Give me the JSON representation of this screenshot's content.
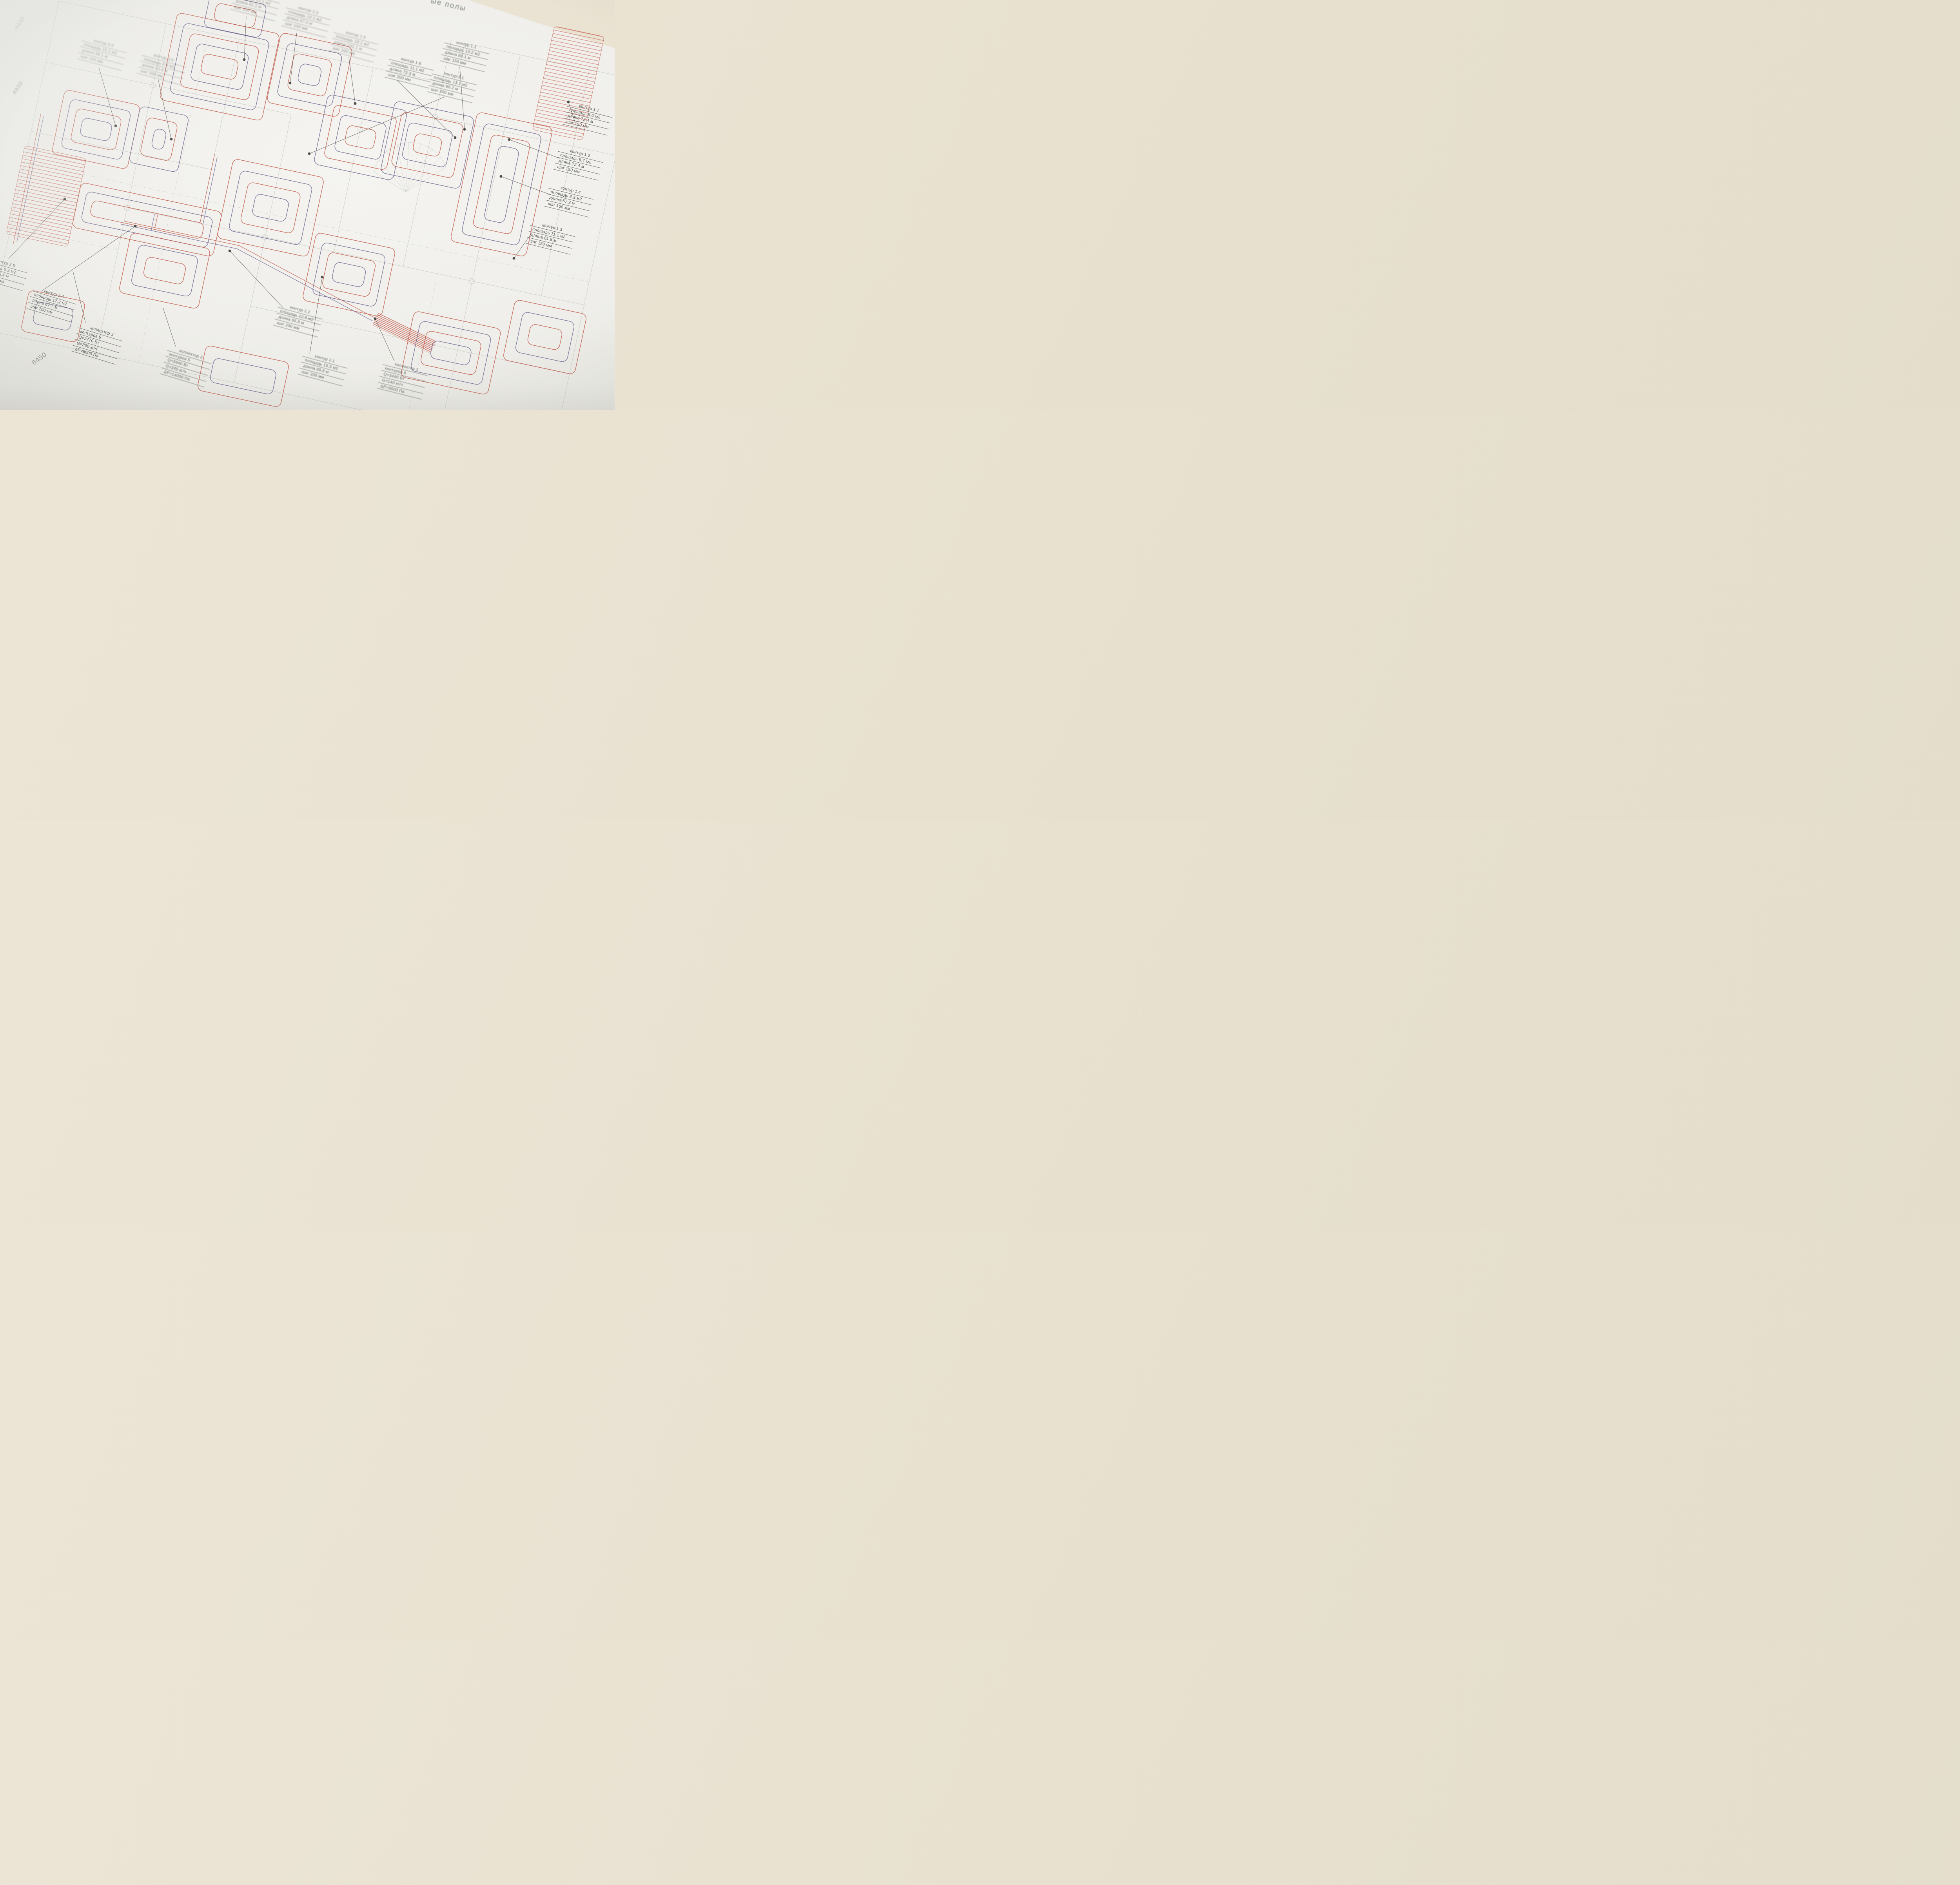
{
  "header": {
    "title_fragment": "ые полы"
  },
  "dimensions": {
    "left_vertical": "4830",
    "top_left": "6430",
    "bottom": "6450"
  },
  "colors": {
    "pipe_supply_red": "#c05847",
    "pipe_red_soft": "#e0a196",
    "pipe_return_blue": "#6e6391",
    "pipe_blue_soft": "#a8a5c3",
    "wall": "#c5c9c5",
    "dashed_axis": "#ced2ce",
    "leader": "#3f3e39",
    "paper": "#f2f1ed",
    "backdrop": "#e8e3d3",
    "ink": "#4b4f4c"
  },
  "loops": [
    {
      "title": "контур 3.5",
      "rows": [
        "площадь 15.1 м2",
        "длина 98.1 м",
        "шаг 150 мм"
      ]
    },
    {
      "title": "контур 3.6",
      "rows": [
        "площадь 8.8 м2",
        "длина 52.8 м",
        "шаг 200 мм"
      ]
    },
    {
      "title": "контур 3.3",
      "rows": [
        "площадь 12.1 м2",
        "длина 81.2 м",
        "шаг 150 мм"
      ]
    },
    {
      "title": "контур 2.3",
      "rows": [
        "площадь 10.1 м2",
        "длина 67.0 м",
        "шаг 150 мм"
      ]
    },
    {
      "title": "контур 1.5",
      "rows": [
        "площадь 18.1 м2",
        "длина 101.1 м",
        "шаг 200 мм"
      ]
    },
    {
      "title": "контур 1.6",
      "rows": [
        "площадь 11.1 м2",
        "длина 75.3 м",
        "шаг 200 мм"
      ]
    },
    {
      "title": "контур 1.1",
      "rows": [
        "площадь 13.2 м2",
        "длина 88.1 м",
        "шаг 150 мм"
      ]
    },
    {
      "title": "контур 3.1",
      "rows": [
        "площадь 13.1 м2",
        "длина 89.2 м",
        "шаг 200 мм"
      ]
    },
    {
      "title": "контур 1.7",
      "rows": [
        "площадь 9.0 м2",
        "длина 72.4 м",
        "шаг 150 мм"
      ]
    },
    {
      "title": "контур 1.2",
      "rows": [
        "площадь 9.7 м2",
        "длина 72.4 м",
        "шаг 150 мм"
      ]
    },
    {
      "title": "контур 1.4",
      "rows": [
        "площадь 8.3 м2",
        "длина 67.2 м",
        "шаг 150 мм"
      ]
    },
    {
      "title": "контур 1.3",
      "rows": [
        "площадь 11.1 м2",
        "длина 81.8 м",
        "шаг 150 мм"
      ]
    },
    {
      "title": "контур 2.5",
      "rows": [
        "площадь 6.3 м2",
        "длина 38.4 м",
        "шаг 200 мм"
      ]
    },
    {
      "title": "контур 2.4",
      "rows": [
        "площадь 17.2 м2",
        "длина 87.7 м",
        "шаг 200 мм"
      ]
    },
    {
      "title": "контур 2.2",
      "rows": [
        "площадь 12.9 м2",
        "длина 65.8 м",
        "шаг 200 мм"
      ]
    },
    {
      "title": "контур 2.1",
      "rows": [
        "площадь 15.5 м2",
        "длина 88.8 м",
        "шаг 200 мм"
      ]
    }
  ],
  "collectors": [
    {
      "title": "коллектор 3",
      "rows": [
        "контуров 6",
        "Q=3770 Вт",
        "G=330 кг/ч",
        "ΔР=8000 Па"
      ]
    },
    {
      "title": "коллектор 2",
      "rows": [
        "контуров 5",
        "Q=3940 Вт",
        "G=340 кг/ч",
        "ΔР=14000 Па"
      ]
    },
    {
      "title": "коллектор 1",
      "rows": [
        "контуров 8",
        "Q=3440 Вт",
        "G=140 кг/ч",
        "ΔР=9000 Па"
      ]
    }
  ]
}
